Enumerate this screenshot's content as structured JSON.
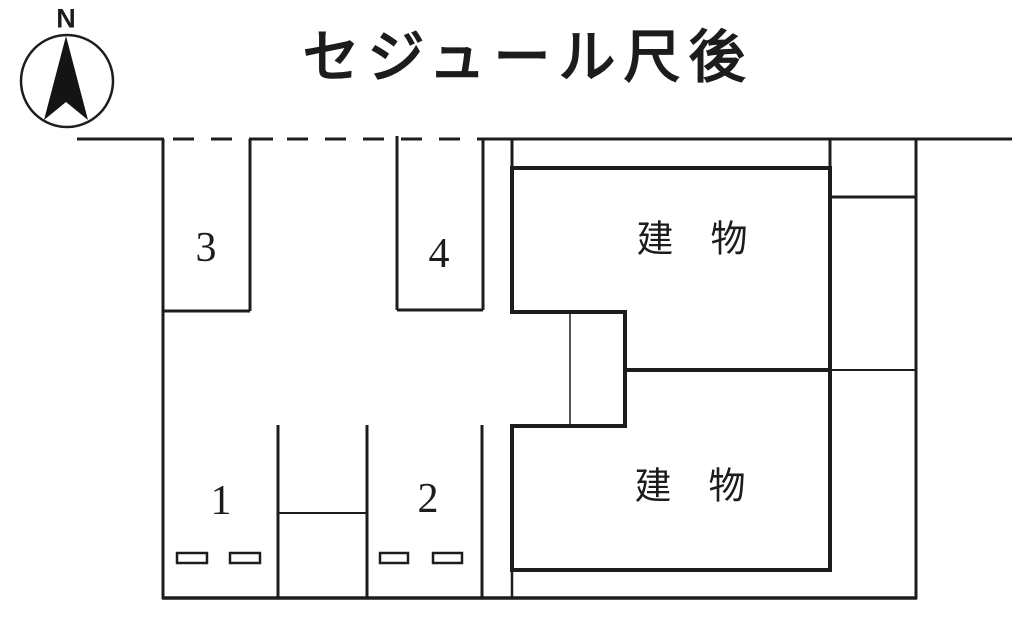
{
  "title": "セジュール尺後",
  "compass": {
    "label": "N"
  },
  "parking_spaces": [
    {
      "number": "3"
    },
    {
      "number": "4"
    },
    {
      "number": "1"
    },
    {
      "number": "2"
    }
  ],
  "buildings": [
    {
      "label": "建　物"
    },
    {
      "label": "建　物"
    }
  ],
  "colors": {
    "line": "#1d1d1d",
    "background": "#ffffff"
  }
}
